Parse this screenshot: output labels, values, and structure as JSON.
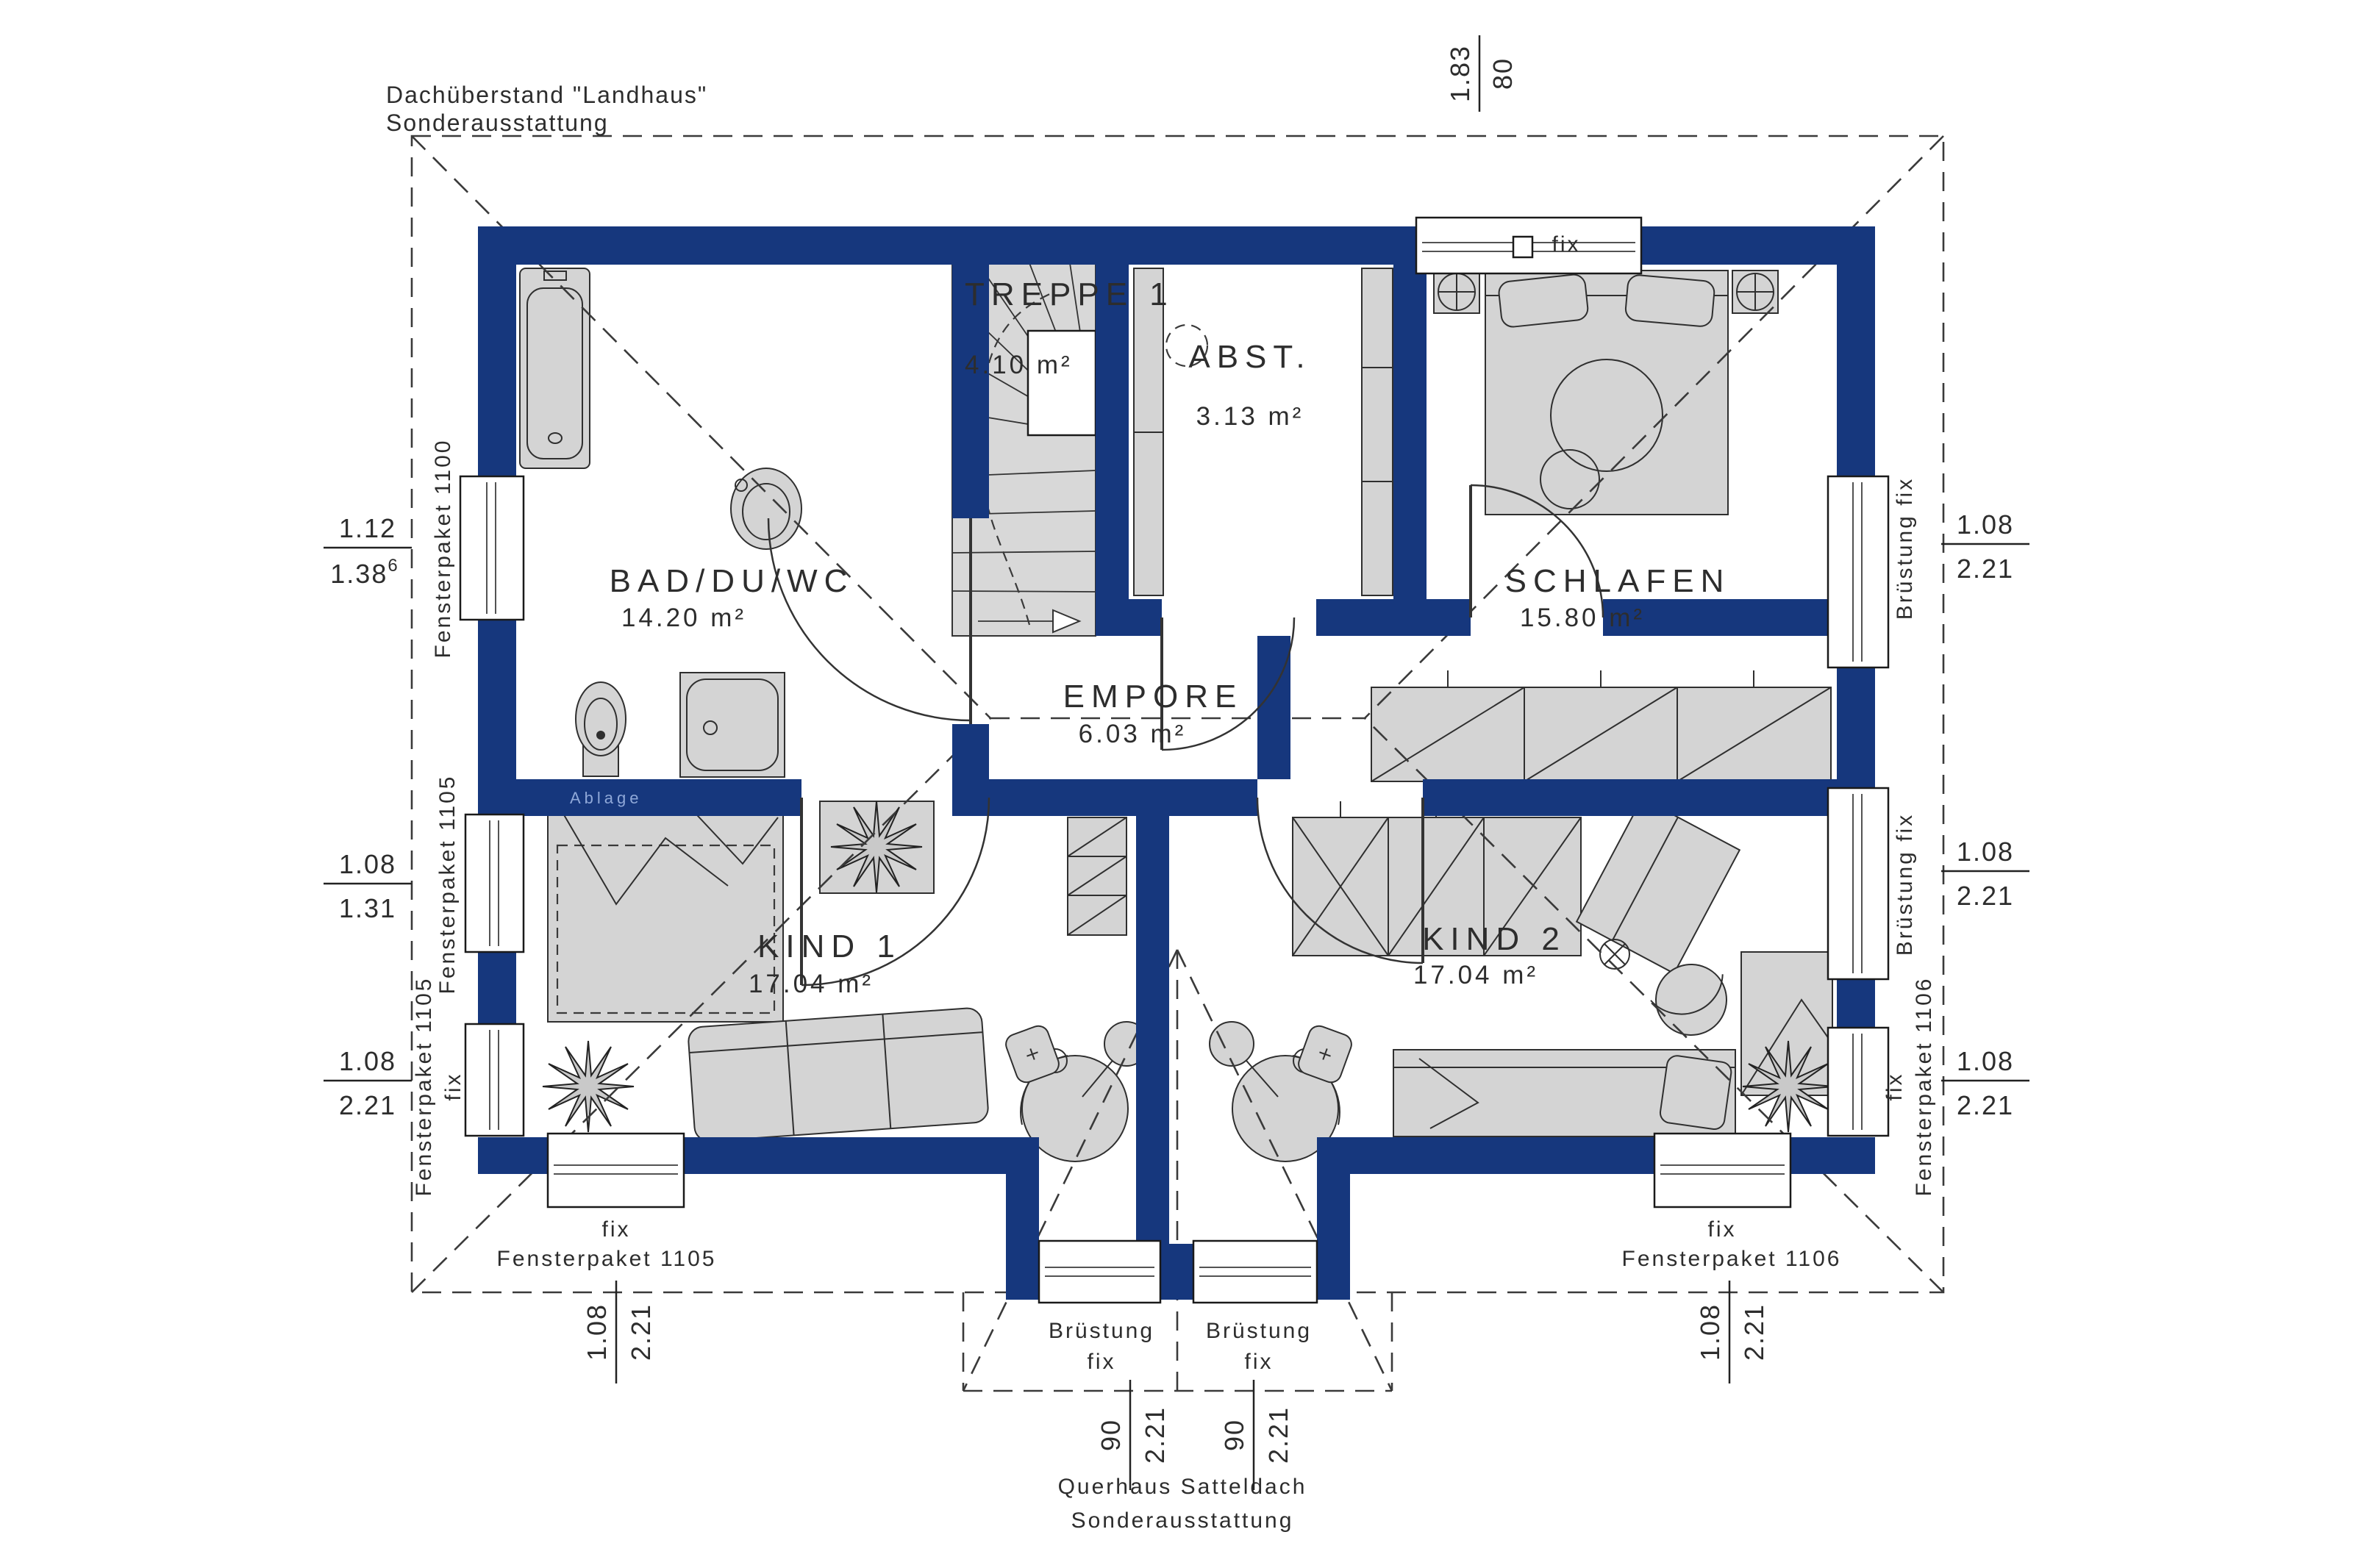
{
  "annotations": {
    "roof_note_line1": "Dachüberstand \"Landhaus\"",
    "roof_note_line2": "Sonderausstattung",
    "dormer_note_line1": "Querhaus Satteldach",
    "dormer_note_line2": "Sonderausstattung",
    "shelf_label": "Ablage"
  },
  "rooms": [
    {
      "name": "TREPPE 1",
      "area": "4.10 m²"
    },
    {
      "name": "ABST.",
      "area": "3.13 m²"
    },
    {
      "name": "SCHLAFEN",
      "area": "15.80 m²"
    },
    {
      "name": "BAD/DU/WC",
      "area": "14.20 m²"
    },
    {
      "name": "EMPORE",
      "area": "6.03 m²"
    },
    {
      "name": "KIND 1",
      "area": "17.04 m²"
    },
    {
      "name": "KIND 2",
      "area": "17.04 m²"
    }
  ],
  "window_labels": {
    "top_fix": "fix",
    "left_f1100": "Fensterpaket 1100",
    "left_f1105": "Fensterpaket 1105",
    "left_f1105_fix": "fix",
    "left_f1105_fix_paket": "Fensterpaket 1105",
    "bottom_left_fix": "fix",
    "bottom_left_paket": "Fensterpaket 1105",
    "bottom_right_fix": "fix",
    "bottom_right_paket": "Fensterpaket 1106",
    "right_bruestung_1": "Brüstung fix",
    "right_bruestung_2": "Brüstung fix",
    "right_f1106_fix": "fix",
    "right_f1106_paket": "Fensterpaket 1106",
    "dormer_left_line1": "Brüstung",
    "dormer_left_line2": "fix",
    "dormer_right_line1": "Brüstung",
    "dormer_right_line2": "fix"
  },
  "dimensions": {
    "top": {
      "num": "1.83",
      "den": "80"
    },
    "left_1": {
      "num": "1.12",
      "den": "1.38",
      "sup": "6"
    },
    "left_2": {
      "num": "1.08",
      "den": "1.31"
    },
    "left_3": {
      "num": "1.08",
      "den": "2.21"
    },
    "right_1": {
      "num": "1.08",
      "den": "2.21"
    },
    "right_2": {
      "num": "1.08",
      "den": "2.21"
    },
    "right_3": {
      "num": "1.08",
      "den": "2.21"
    },
    "bottom_left": {
      "num": "1.08",
      "den": "2.21"
    },
    "bottom_right": {
      "num": "1.08",
      "den": "2.21"
    },
    "dormer_left": {
      "num": "90",
      "den": "2.21"
    },
    "dormer_right": {
      "num": "90",
      "den": "2.21"
    }
  },
  "colors": {
    "wall": "#16377d",
    "furniture": "#d4d4d4",
    "line": "#333333"
  }
}
